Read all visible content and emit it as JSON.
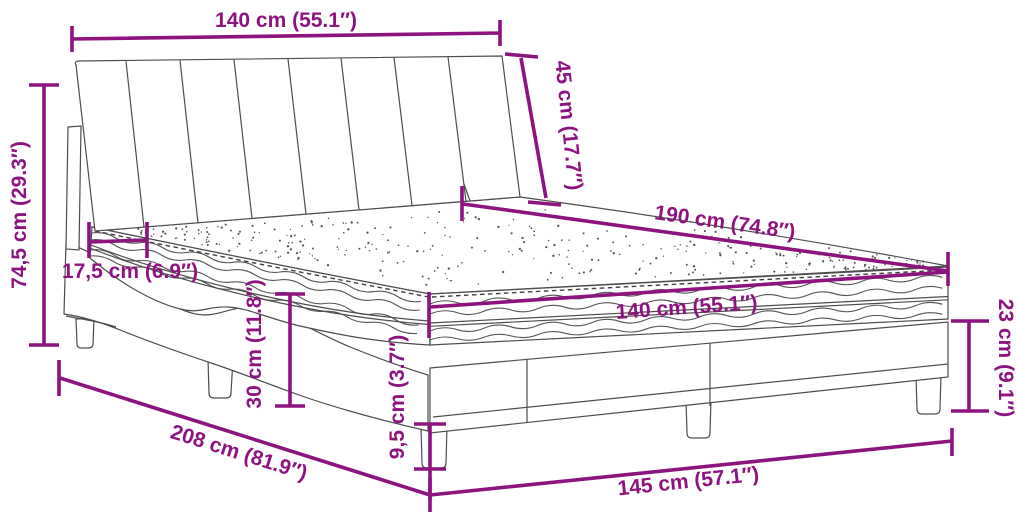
{
  "diagram": {
    "title": "Bed with mattress – dimension diagram",
    "colors": {
      "dimension": "#8D1480",
      "line_art": "#4d4d4d",
      "background": "#ffffff"
    },
    "dimensions": [
      {
        "id": "headboard-width",
        "label": "140 cm (55.1″)"
      },
      {
        "id": "headboard-height",
        "label": "45 cm (17.7″)"
      },
      {
        "id": "overall-height",
        "label": "74,5 cm (29.3″)"
      },
      {
        "id": "mattress-thickness",
        "label": "17,5 cm (6.9″)"
      },
      {
        "id": "mattress-length",
        "label": "190 cm (74.8″)"
      },
      {
        "id": "mattress-width",
        "label": "140 cm (55.1″)"
      },
      {
        "id": "base-and-leg-height",
        "label": "23 cm (9.1″)"
      },
      {
        "id": "frame-height",
        "label": "30 cm (11.8″)"
      },
      {
        "id": "leg-height",
        "label": "9,5 cm (3.7″)"
      },
      {
        "id": "overall-length",
        "label": "208 cm (81.9″)"
      },
      {
        "id": "overall-width",
        "label": "145 cm (57.1″)"
      }
    ]
  }
}
